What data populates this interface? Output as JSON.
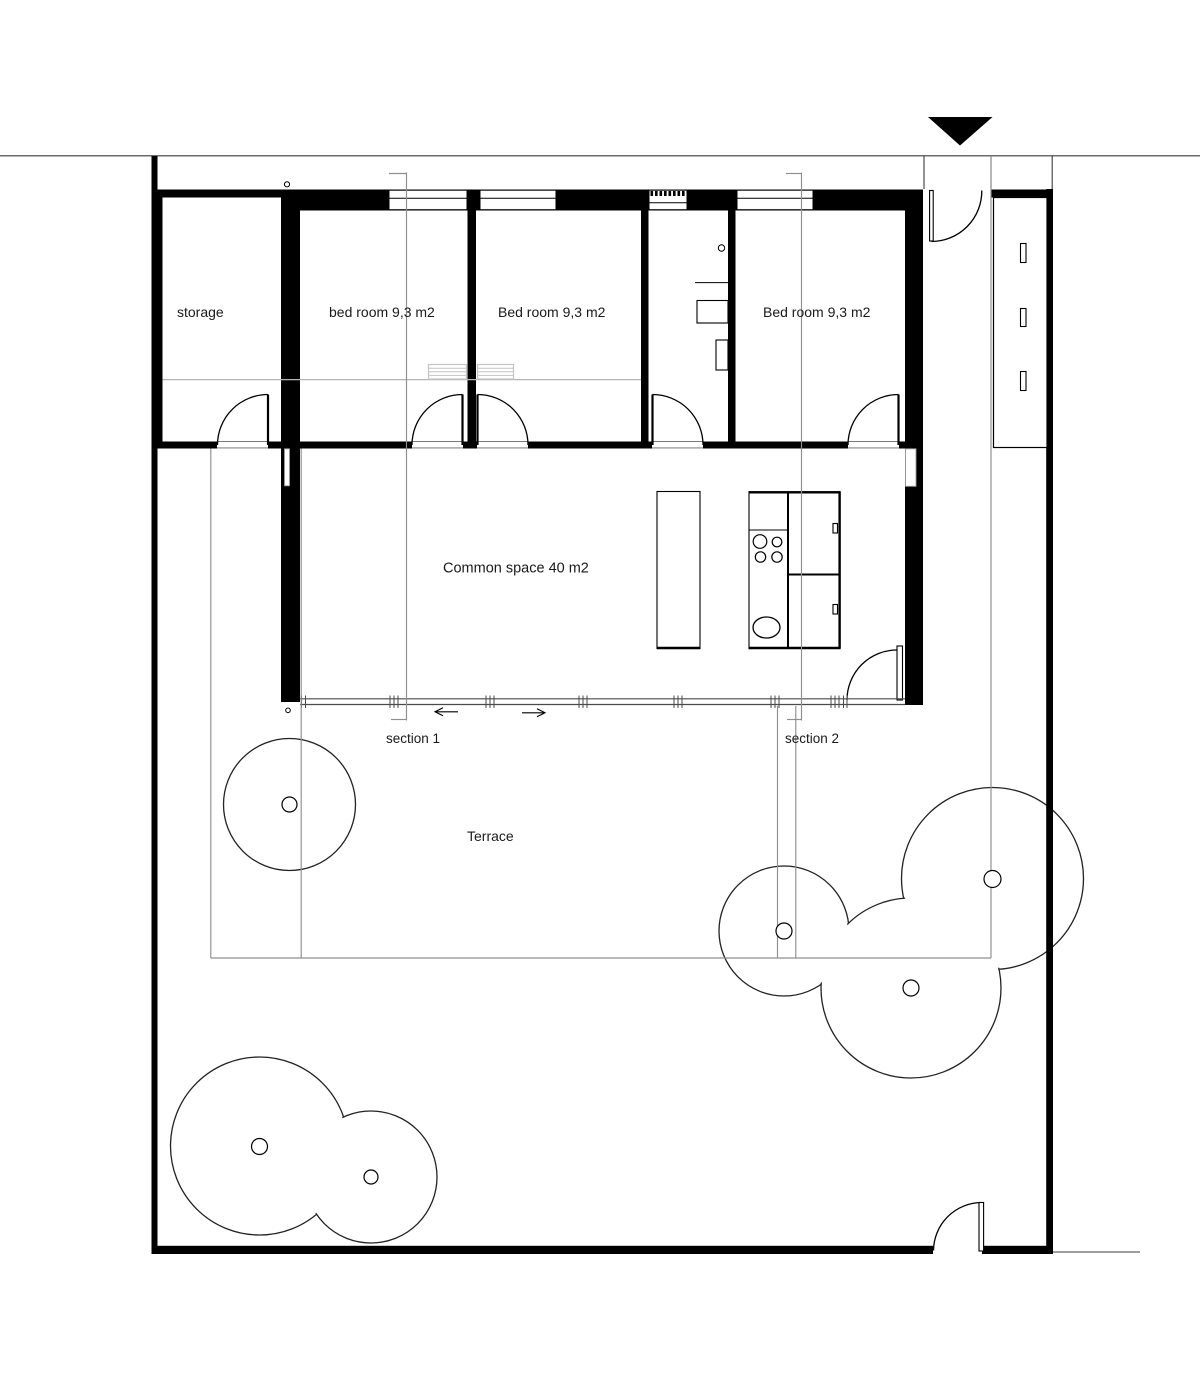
{
  "document": {
    "kind": "architectural floor plan drawing"
  },
  "rooms": {
    "storage": {
      "label": "storage"
    },
    "bedroom_1": {
      "label": "bed room 9,3 m2"
    },
    "bedroom_2": {
      "label": "Bed room 9,3 m2"
    },
    "bedroom_3": {
      "label": "Bed room 9,3 m2"
    },
    "common_space": {
      "label": "Common space 40 m2"
    },
    "terrace": {
      "label": "Terrace"
    }
  },
  "sections": {
    "section_1": {
      "label": "section 1"
    },
    "section_2": {
      "label": "section 2"
    }
  },
  "icons": {
    "entrance_marker": "black triangle pointing down at site entrance"
  },
  "colors": {
    "wall": "#000000",
    "background": "#ffffff",
    "site_line": "#3c3c3c",
    "guide_line": "#8f8f8f",
    "facade_line": "#4a4a4a",
    "radiator_line": "#c4c4c4"
  }
}
